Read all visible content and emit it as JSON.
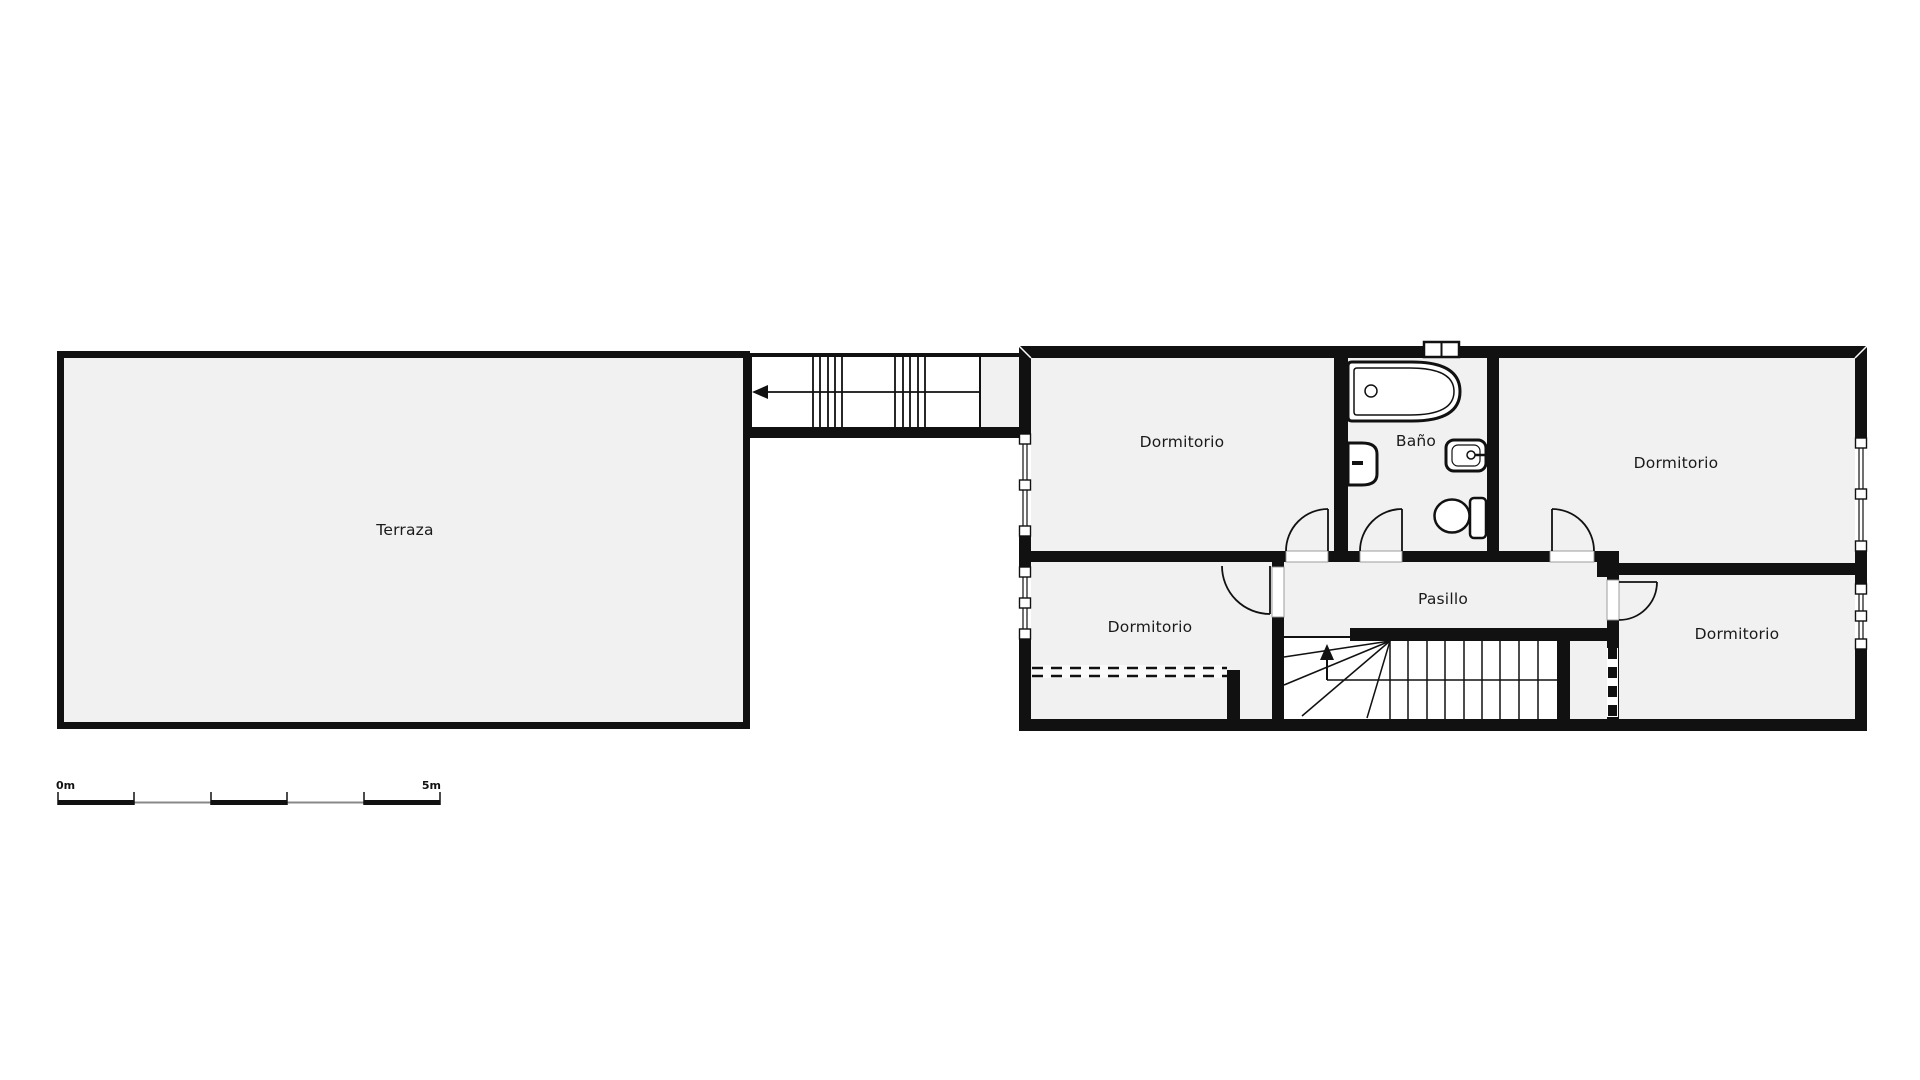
{
  "floor_plan": {
    "rooms": {
      "terraza": {
        "label": "Terraza"
      },
      "bedroom_top_left": {
        "label": "Dormitorio"
      },
      "bathroom": {
        "label": "Baño"
      },
      "bedroom_top_right": {
        "label": "Dormitorio"
      },
      "bedroom_bottom_left": {
        "label": "Dormitorio"
      },
      "hallway": {
        "label": "Pasillo"
      },
      "bedroom_bottom_right": {
        "label": "Dormitorio"
      }
    },
    "scale_bar": {
      "start_label": "0m",
      "end_label": "5m"
    },
    "colors": {
      "wall": "#111111",
      "room_fill": "#f1f1f1",
      "background": "#ffffff",
      "line": "#1a1a1a",
      "scale_thin": "#888888"
    },
    "icons": [
      "bathtub-icon",
      "sink-icon",
      "bidet-icon",
      "toilet-icon",
      "window-icon",
      "door-arc-icon",
      "stairs-up-arrow-icon",
      "stairs-direction-arrow-icon"
    ]
  }
}
